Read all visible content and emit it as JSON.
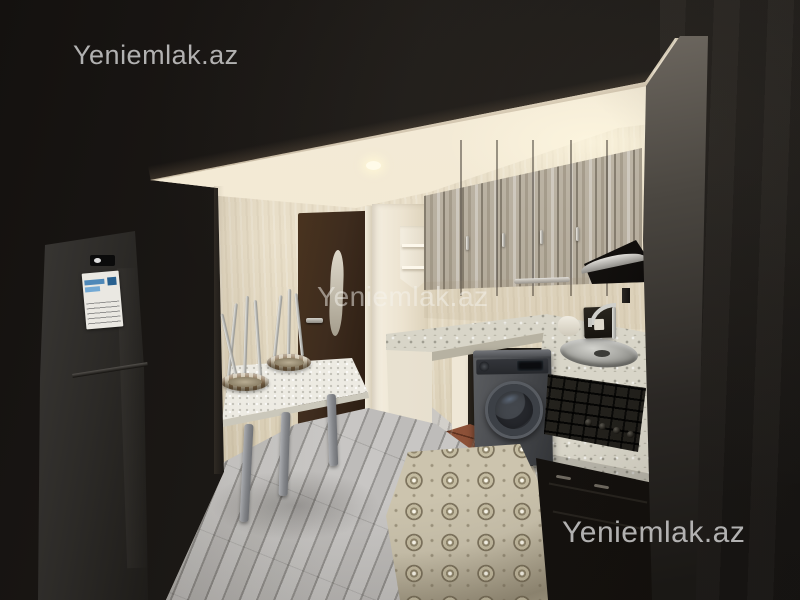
{
  "watermarks": {
    "top_left": "Yeniemlak.az",
    "center": "Yeniemlak.az",
    "bottom_right": "Yeniemlak.az"
  },
  "colors": {
    "frame_dark": "#171310",
    "ceiling_cream": "#f2e9d4",
    "wall_cream": "#e3d9c2",
    "cabinet_wood_light": "#b3a996",
    "door_brown": "#3e2c1e",
    "counter_speckle": "#d8d5c8",
    "counter_white_panel": "#f3eee0",
    "laminate_gray": "#b5b3b0",
    "tile_terracotta": "#8d5138",
    "rug_beige": "#ccc4ae",
    "appliance_gray": "#4a4c50",
    "stove_black": "#23211c",
    "hood_black": "#0d0b0a",
    "fridge_gray": "#2c2a27",
    "watermark_gray": "#cdcdcd"
  }
}
